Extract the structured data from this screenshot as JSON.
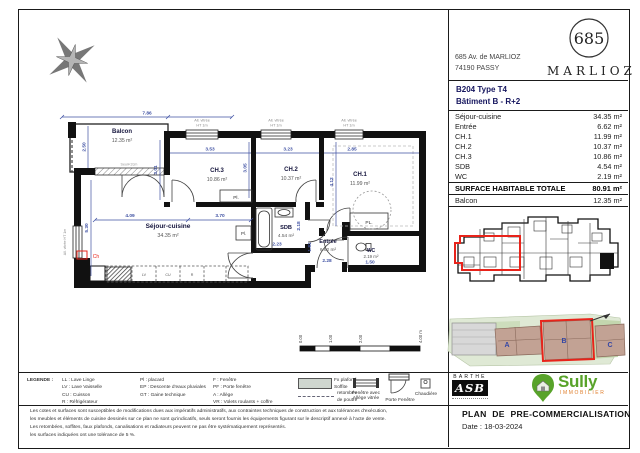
{
  "header": {
    "address_line1": "685 Av. de MARLIOZ",
    "address_line2": "74190 PASSY",
    "logo_number": "685",
    "logo_name": "MARLIOZ"
  },
  "unit": {
    "reference": "B204 Type T4",
    "building": "Bâtiment B -  R+2"
  },
  "area_table": {
    "rows": [
      {
        "label": "Séjour-cuisine",
        "value": "34.35 m²"
      },
      {
        "label": "Entrée",
        "value": "6.62 m²"
      },
      {
        "label": "CH.1",
        "value": "11.99 m²"
      },
      {
        "label": "CH.2",
        "value": "10.37 m²"
      },
      {
        "label": "CH.3",
        "value": "10.86 m²"
      },
      {
        "label": "SDB",
        "value": "4.54 m²"
      },
      {
        "label": "WC",
        "value": "2.19 m²"
      }
    ],
    "total_label": "SURFACE HABITABLE TOTALE",
    "total_value": "80.91 m²",
    "balcony_label": "Balcon",
    "balcony_value": "12.35 m²"
  },
  "plan": {
    "rooms": {
      "balcon": {
        "name": "Balcon",
        "area": "12.35 m²"
      },
      "sejour": {
        "name": "Séjour-cuisine",
        "area": "34.35 m²"
      },
      "ch1": {
        "name": "CH.1",
        "area": "11.99 m²"
      },
      "ch2": {
        "name": "CH.2",
        "area": "10.37 m²"
      },
      "ch3": {
        "name": "CH.3",
        "area": "10.86 m²"
      },
      "sdb": {
        "name": "SDB",
        "area": "4.54 m²"
      },
      "entree": {
        "name": "Entrée",
        "area": "6.62 m²"
      },
      "wc": {
        "name": "WC",
        "area": "2.19 m²"
      }
    },
    "dims": {
      "top_width": "7.86",
      "balcon_depth": "2.50",
      "ch3_width": "3.53",
      "ch3_depth": "3.01",
      "ch2_width": "3.23",
      "ch2_depth": "3.05",
      "ch1_width": "2.85",
      "ch1_depth": "4.12",
      "sejour_w1": "4.09",
      "sejour_w2": "3.70",
      "sejour_depth": "5.30",
      "sdb_width": "2.23",
      "sdb_depth": "2.18",
      "entree_width": "2.28",
      "entree_depth": "1.81",
      "wc_width": "1.50"
    },
    "annotations": {
      "placard": "Pl.",
      "placard_caps": "PL.",
      "chaudiere": "Ch",
      "window_note1": "All. vitrée",
      "window_note2": "HT 1m",
      "window_note_side": "All. vitrée HT 1m",
      "seuil": "Seuil<2cm",
      "lv": "LV",
      "cu": "CU",
      "r": "R"
    },
    "scale_bar": [
      "0.00",
      "1.00",
      "2.00",
      "4.00 m"
    ]
  },
  "site_plan": {
    "building_a": "A",
    "building_b": "B",
    "building_c": "C"
  },
  "legend": {
    "title": "LEGENDE :",
    "col1": [
      "LL : Lave Linge",
      "LV : Lave Vaisselle",
      "CU : Cuisson",
      "R : Réfrigérateur"
    ],
    "col2": [
      "Pl : placard",
      "EP : Descente d'eaux pluviales",
      "GT : Gaine technique"
    ],
    "col3": [
      "F : Fenêtre",
      "PF : Porte fenêtre",
      "A : Allège",
      "VR : Volets roulants + coffre"
    ],
    "swatch_label1": "Fx plafond",
    "swatch_label2": "Soffite",
    "dash_label1": "retombée",
    "dash_label2": "de poutre",
    "window_symbol_label1": "Fenêtre avec",
    "window_symbol_label2": "Allège vitrée",
    "door_symbol_label": "Porte Fenêtre",
    "boiler_label": "Chaudière"
  },
  "disclaimer": {
    "line1": "Les cotes et surfaces sont susceptibles de modifications dues aux impératifs administratifs, aux contraintes techniques de construction et aux tolérances d'exécution,",
    "line2": "les meubles et éléments de cuisine dessinés sur ce plan ne sont qu'indicatifs, seuls seront fournis les équipements figurant sur le descriptif annexé à l'acte de vente.",
    "line3": "Les retombées, soffites, faux plafonds, canalisations et radiateurs peuvent ne pas être systématiquement représentés.",
    "line4": "les surfaces indiquées ont une tolérance de 5 %."
  },
  "title_block": {
    "barthe_top": "BARTHE",
    "barthe_main": "ASB",
    "sully_name": "Sully",
    "sully_sub": "IMMOBILIER",
    "title": "PLAN DE PRE-COMMERCIALISATION",
    "date": "Date : 18-03-2024"
  }
}
